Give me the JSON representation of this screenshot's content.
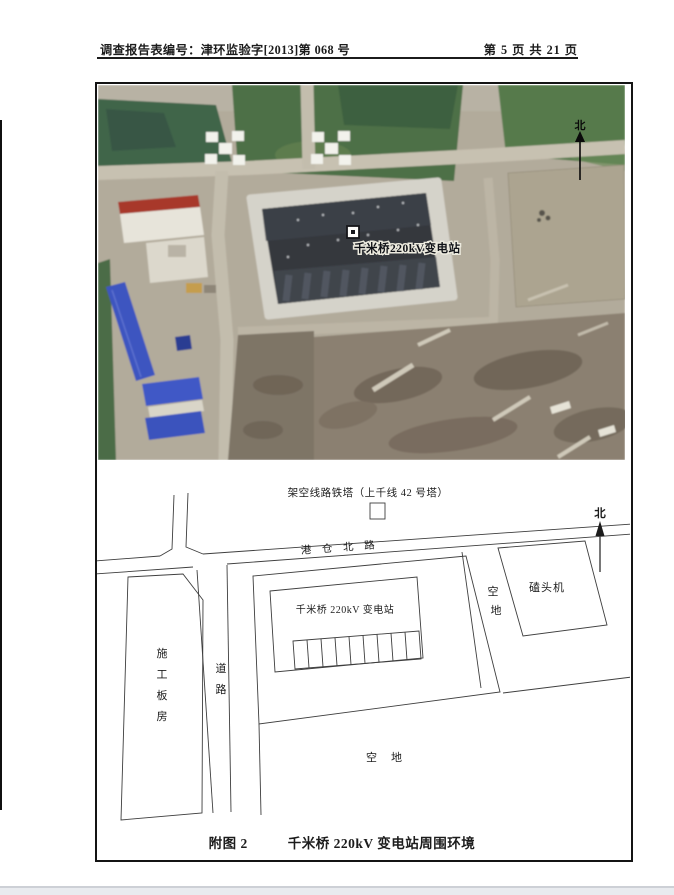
{
  "header": {
    "left": "调查报告表编号：津环监验字[2013]第 068 号",
    "right": "第 5 页 共 21 页"
  },
  "figure": {
    "satellite": {
      "station_label": "千米桥220kV变电站",
      "north_label": "北"
    },
    "diagram": {
      "tower_label": "架空线路铁塔（上千线 42 号塔）",
      "north_label": "北",
      "road_name": "港 仓 北 路",
      "substation_label": "千米桥 220kV 变电站",
      "vacant_side_chars": [
        "空",
        "地"
      ],
      "pumpjack_label": "磕头机",
      "shed_chars": [
        "施",
        "工",
        "板",
        "房"
      ],
      "road_chars": [
        "道",
        "路"
      ],
      "vacant_bottom_label": "空地"
    },
    "caption": {
      "number": "附图 2",
      "title": "千米桥 220kV 变电站周围环境"
    }
  },
  "colors": {
    "paper": "#ffffff",
    "ink": "#1c1c1c",
    "field_green": "#4d7046",
    "dirt_tan": "#b2ab9b",
    "substation_roof": "#34383e",
    "blue_roof": "#3d55c0",
    "gravel_pad": "#d5d3ca"
  }
}
